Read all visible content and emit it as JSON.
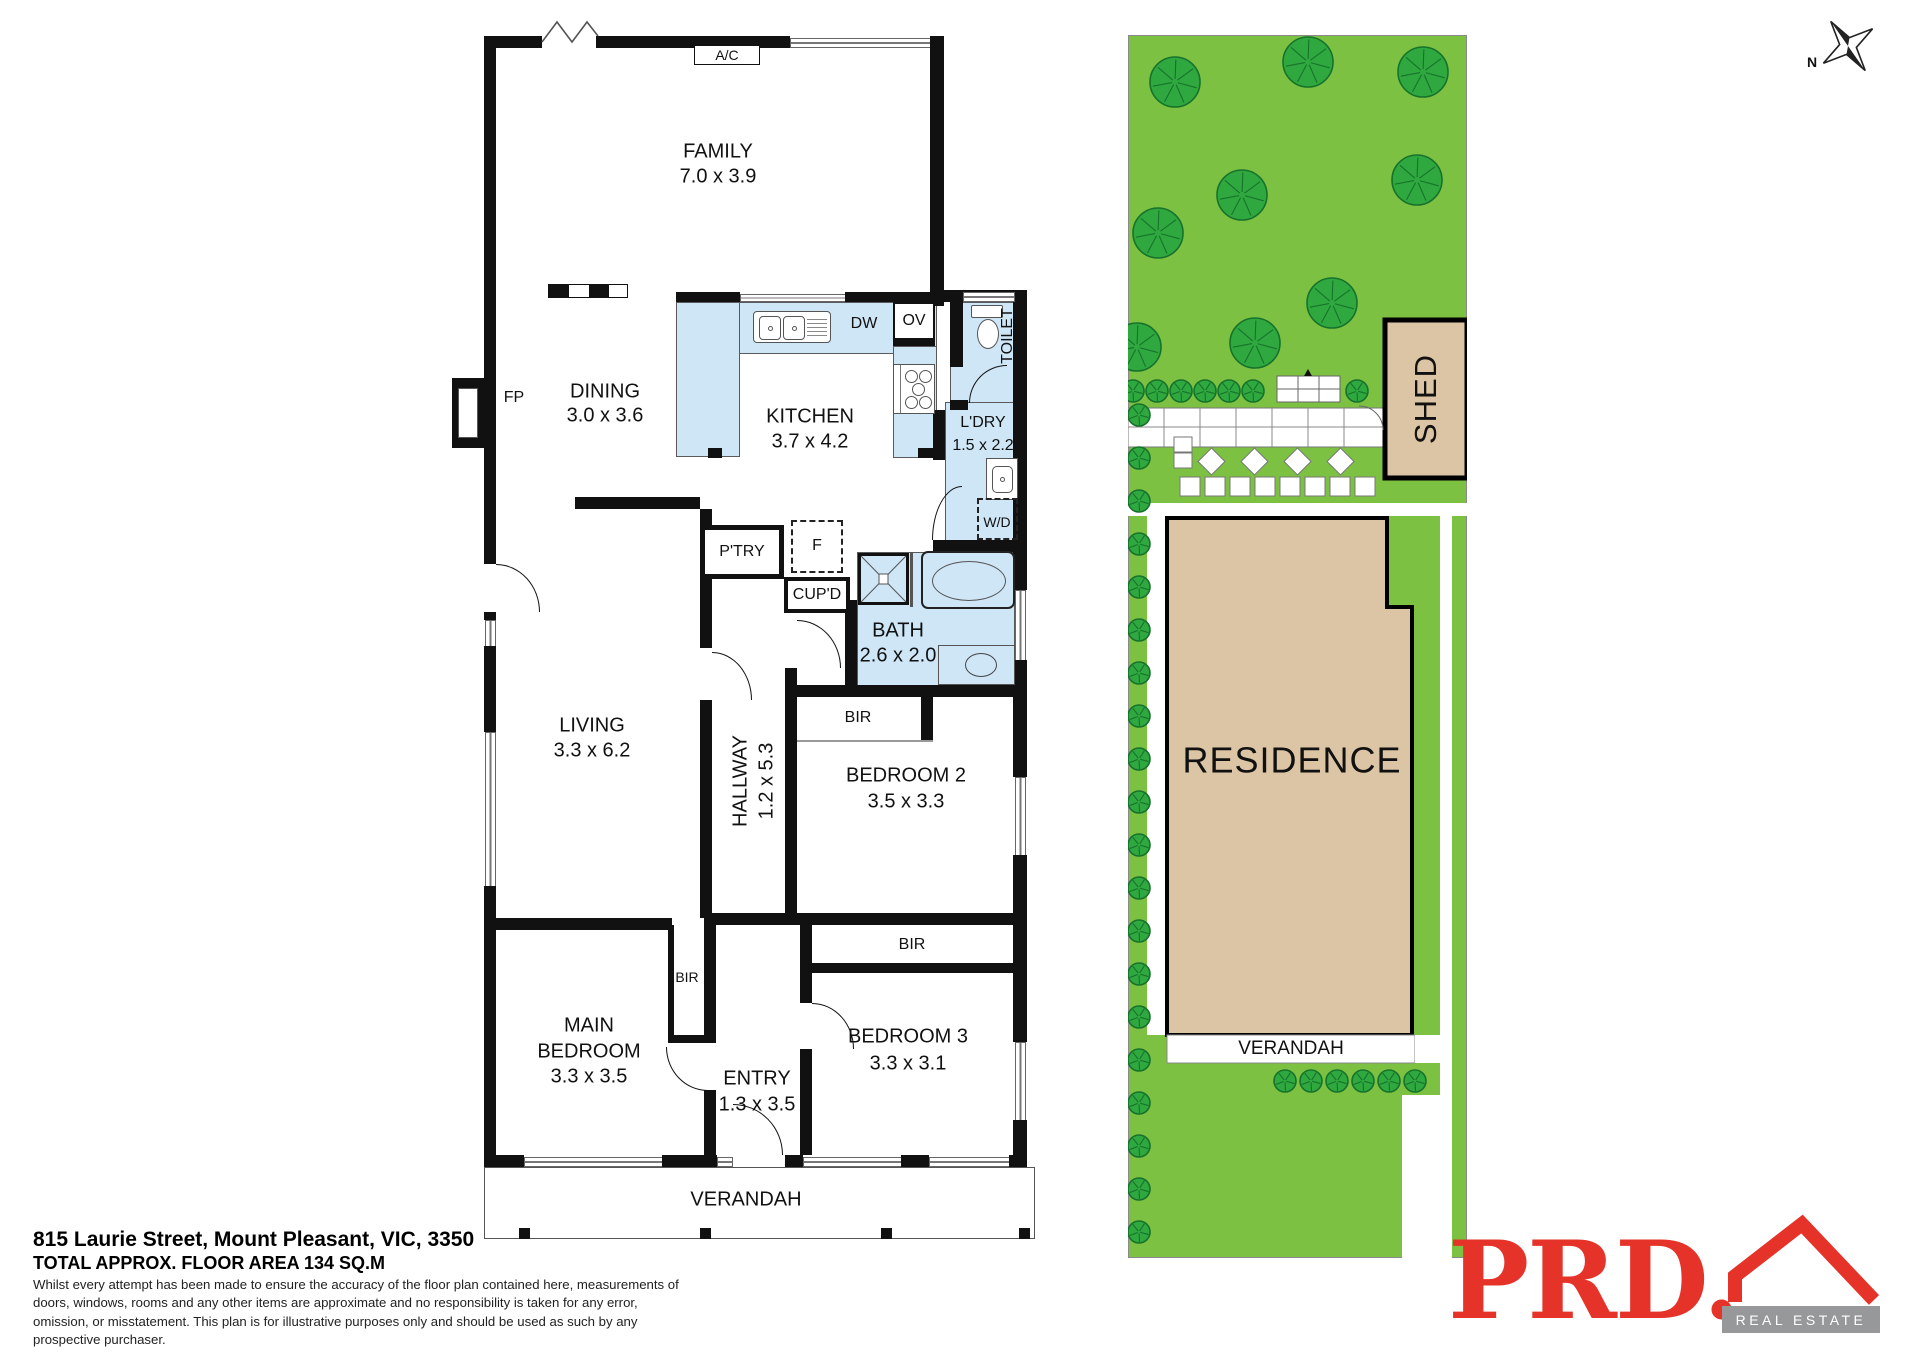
{
  "floor_plan": {
    "rooms": {
      "family": {
        "name": "FAMILY",
        "size": "7.0 x 3.9"
      },
      "dining": {
        "name": "DINING",
        "size": "3.0 x 3.6"
      },
      "kitchen": {
        "name": "KITCHEN",
        "size": "3.7 x 4.2"
      },
      "laundry": {
        "name": "L'DRY",
        "size": "1.5 x 2.2"
      },
      "bath": {
        "name": "BATH",
        "size": "2.6 x 2.0"
      },
      "living": {
        "name": "LIVING",
        "size": "3.3 x 6.2"
      },
      "hallway": {
        "name": "HALLWAY",
        "size": "1.2 x 5.3"
      },
      "bedroom2": {
        "name": "BEDROOM 2",
        "size": "3.5 x 3.3"
      },
      "bedroom3": {
        "name": "BEDROOM 3",
        "size": "3.3 x 3.1"
      },
      "main_bedroom": {
        "line1": "MAIN",
        "line2": "BEDROOM",
        "size": "3.3 x 3.5"
      },
      "entry": {
        "name": "ENTRY",
        "size": "1.3 x 3.5"
      },
      "toilet": {
        "name": "TOILET"
      },
      "verandah": {
        "name": "VERANDAH"
      }
    },
    "fixtures": {
      "ac": "A/C",
      "fp": "FP",
      "dw": "DW",
      "ov": "OV",
      "wd": "W/D",
      "pantry": "P'TRY",
      "fridge": "F",
      "cupboard": "CUP'D",
      "bir": "BIR"
    }
  },
  "site_plan": {
    "residence_label": "RESIDENCE",
    "shed_label": "SHED",
    "verandah_label": "VERANDAH",
    "trees": [
      {
        "x": 1175,
        "y": 82,
        "r": 25
      },
      {
        "x": 1308,
        "y": 62,
        "r": 25
      },
      {
        "x": 1423,
        "y": 72,
        "r": 25
      },
      {
        "x": 1417,
        "y": 180,
        "r": 25
      },
      {
        "x": 1242,
        "y": 195,
        "r": 25
      },
      {
        "x": 1158,
        "y": 233,
        "r": 25
      },
      {
        "x": 1332,
        "y": 303,
        "r": 25
      },
      {
        "x": 1255,
        "y": 343,
        "r": 25
      },
      {
        "x": 1137,
        "y": 347,
        "r": 24
      }
    ],
    "bush_row_top": {
      "y": 391,
      "r": 11,
      "xs": [
        1133,
        1157,
        1181,
        1205,
        1229,
        1253,
        1357
      ]
    },
    "bush_column_left": {
      "x": 1139,
      "y_start": 415,
      "step": 43,
      "count": 20,
      "r": 11
    },
    "bush_row_verandah": {
      "y": 1081,
      "r": 11,
      "x_start": 1285,
      "step": 26,
      "count": 6
    }
  },
  "compass": {
    "label": "N"
  },
  "footer": {
    "address": "815 Laurie Street, Mount Pleasant, VIC, 3350",
    "floor_area": "TOTAL APPROX. FLOOR AREA 134 SQ.M",
    "disclaimer": "Whilst every attempt has been made to ensure the accuracy of the floor plan contained here, measurements of doors, windows, rooms and any other items are approximate and no responsibility is taken for any error, omission, or misstatement. This plan is for illustrative purposes only and should be used as such by any prospective purchaser."
  },
  "logo": {
    "brand": "PRD.",
    "tagline": "REAL ESTATE"
  },
  "colors": {
    "wet_area": "#CFE6F7",
    "lawn": "#7CC142",
    "tree_fill": "#2FA93F",
    "tree_stroke": "#17722B",
    "structure_tan": "#DCC5A4",
    "wall": "#111111",
    "brand_red": "#E6332A",
    "bar_gray": "#97989A"
  }
}
